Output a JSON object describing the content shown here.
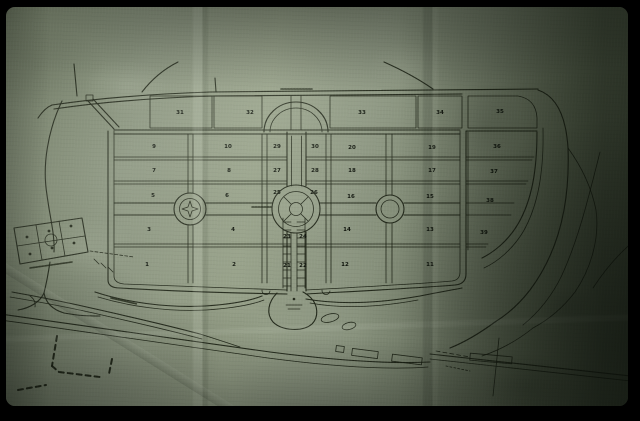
{
  "photo": {
    "subject": "Photograph (35mm-slide style, black frame) of an old master-plan map drawn on aged, creased green-grey paper",
    "frame_color": "#000000",
    "paper_base_color": "#87917c",
    "ink_color": "#1a2012"
  },
  "map": {
    "blocks": [
      "31",
      "32",
      "33",
      "34",
      "35",
      "9",
      "10",
      "29",
      "30",
      "20",
      "19",
      "36",
      "7",
      "8",
      "27",
      "28",
      "18",
      "17",
      "37",
      "5",
      "6",
      "25",
      "26",
      "16",
      "15",
      "38",
      "3",
      "4",
      "23",
      "24",
      "14",
      "13",
      "39",
      "1",
      "2",
      "21",
      "22",
      "12",
      "11"
    ],
    "block_layout": {
      "top_row": [
        "31",
        "32",
        "33",
        "34",
        "35"
      ],
      "east_column": [
        "36",
        "37",
        "38",
        "39"
      ],
      "main_grid_rows": [
        [
          "9",
          "10",
          "29",
          "30",
          "20",
          "19"
        ],
        [
          "7",
          "8",
          "27",
          "28",
          "18",
          "17"
        ],
        [
          "5",
          "6",
          "25",
          "26",
          "16",
          "15"
        ],
        [
          "3",
          "4",
          "23",
          "24",
          "14",
          "13"
        ],
        [
          "1",
          "2",
          "21",
          "22",
          "12",
          "11"
        ]
      ]
    },
    "features": {
      "central_roundabout": "large concentric circular plaza at center of grid",
      "west_circle": "circular plaza with star ornament on west axis",
      "east_circle": "plain circular plaza on east axis",
      "entrance_arc": "arched entrance plaza at head of central avenue",
      "annex": "small skewed six-lot annex block outside the south-west corner",
      "lake": "U-shaped lagoon with islets below the south edge of the grid",
      "railway": "double-line road/railway with platform building at lower right",
      "parkway": "winding diagonal parkway crossing the bottom of the sheet"
    },
    "illegible_labels_note": "Several tiny street-name inscriptions (top road, central avenue, annex, south-west road, lagoon) are present but not legible at photo resolution"
  }
}
